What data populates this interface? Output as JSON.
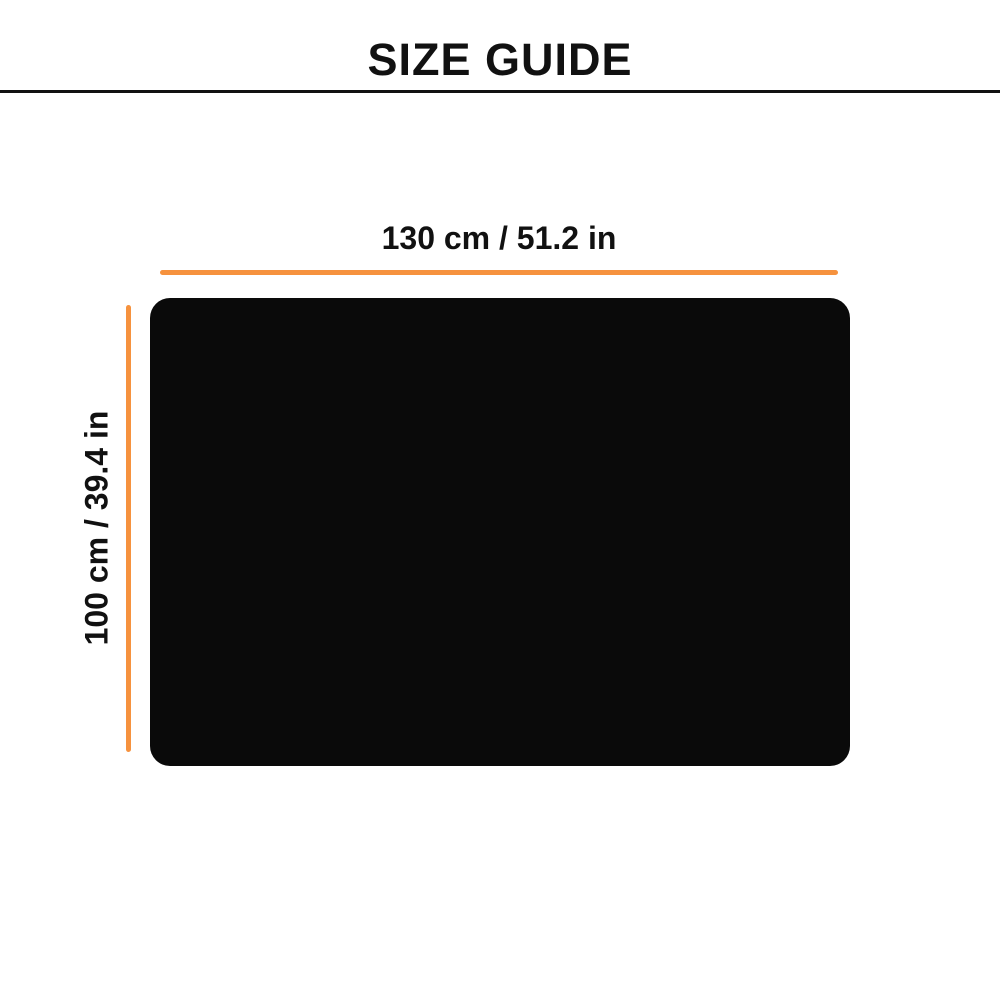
{
  "page": {
    "title": "SIZE GUIDE"
  },
  "diagram": {
    "width_dimension": {
      "label": "130 cm / 51.2 in",
      "value_cm": 130,
      "value_in": 51.2
    },
    "height_dimension": {
      "label": "100 cm / 39.4 in",
      "value_cm": 100,
      "value_in": 39.4
    }
  },
  "colors": {
    "accent": "#f6923e",
    "product": "#0a0a0a",
    "ink": "#111111",
    "bg": "#ffffff"
  }
}
